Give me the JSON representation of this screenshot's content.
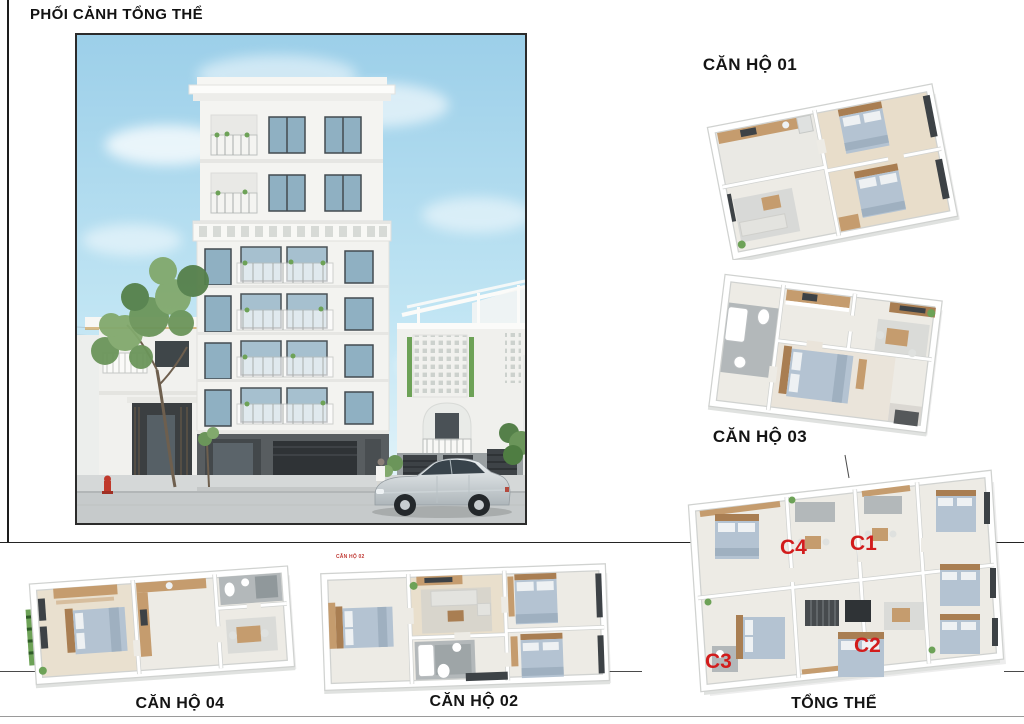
{
  "title": "PHỐI CẢNH TỔNG THỂ",
  "panels": {
    "perspective": {
      "caption": "PHỐI CẢNH TỔNG THỂ"
    },
    "apt01": {
      "label": "CĂN HỘ 01"
    },
    "apt02": {
      "label": "CĂN HỘ 02",
      "watermark": "CĂN HỘ 02"
    },
    "apt03": {
      "label": "CĂN HỘ 03"
    },
    "apt04": {
      "label": "CĂN HỘ 04"
    },
    "overall": {
      "label": "TỔNG THỂ",
      "units": {
        "c1": "C1",
        "c2": "C2",
        "c3": "C3",
        "c4": "C4"
      }
    }
  },
  "colors": {
    "unit_label_red": "#d21c1c",
    "label_text": "#141414",
    "sky": "#a9d9ee",
    "building_white": "#f3f3f0",
    "window_glass": "#8fb0c2",
    "ground_floor_dark": "#55595c",
    "wood": "#c59c6e",
    "bed_fabric": "#b4c3d2"
  }
}
